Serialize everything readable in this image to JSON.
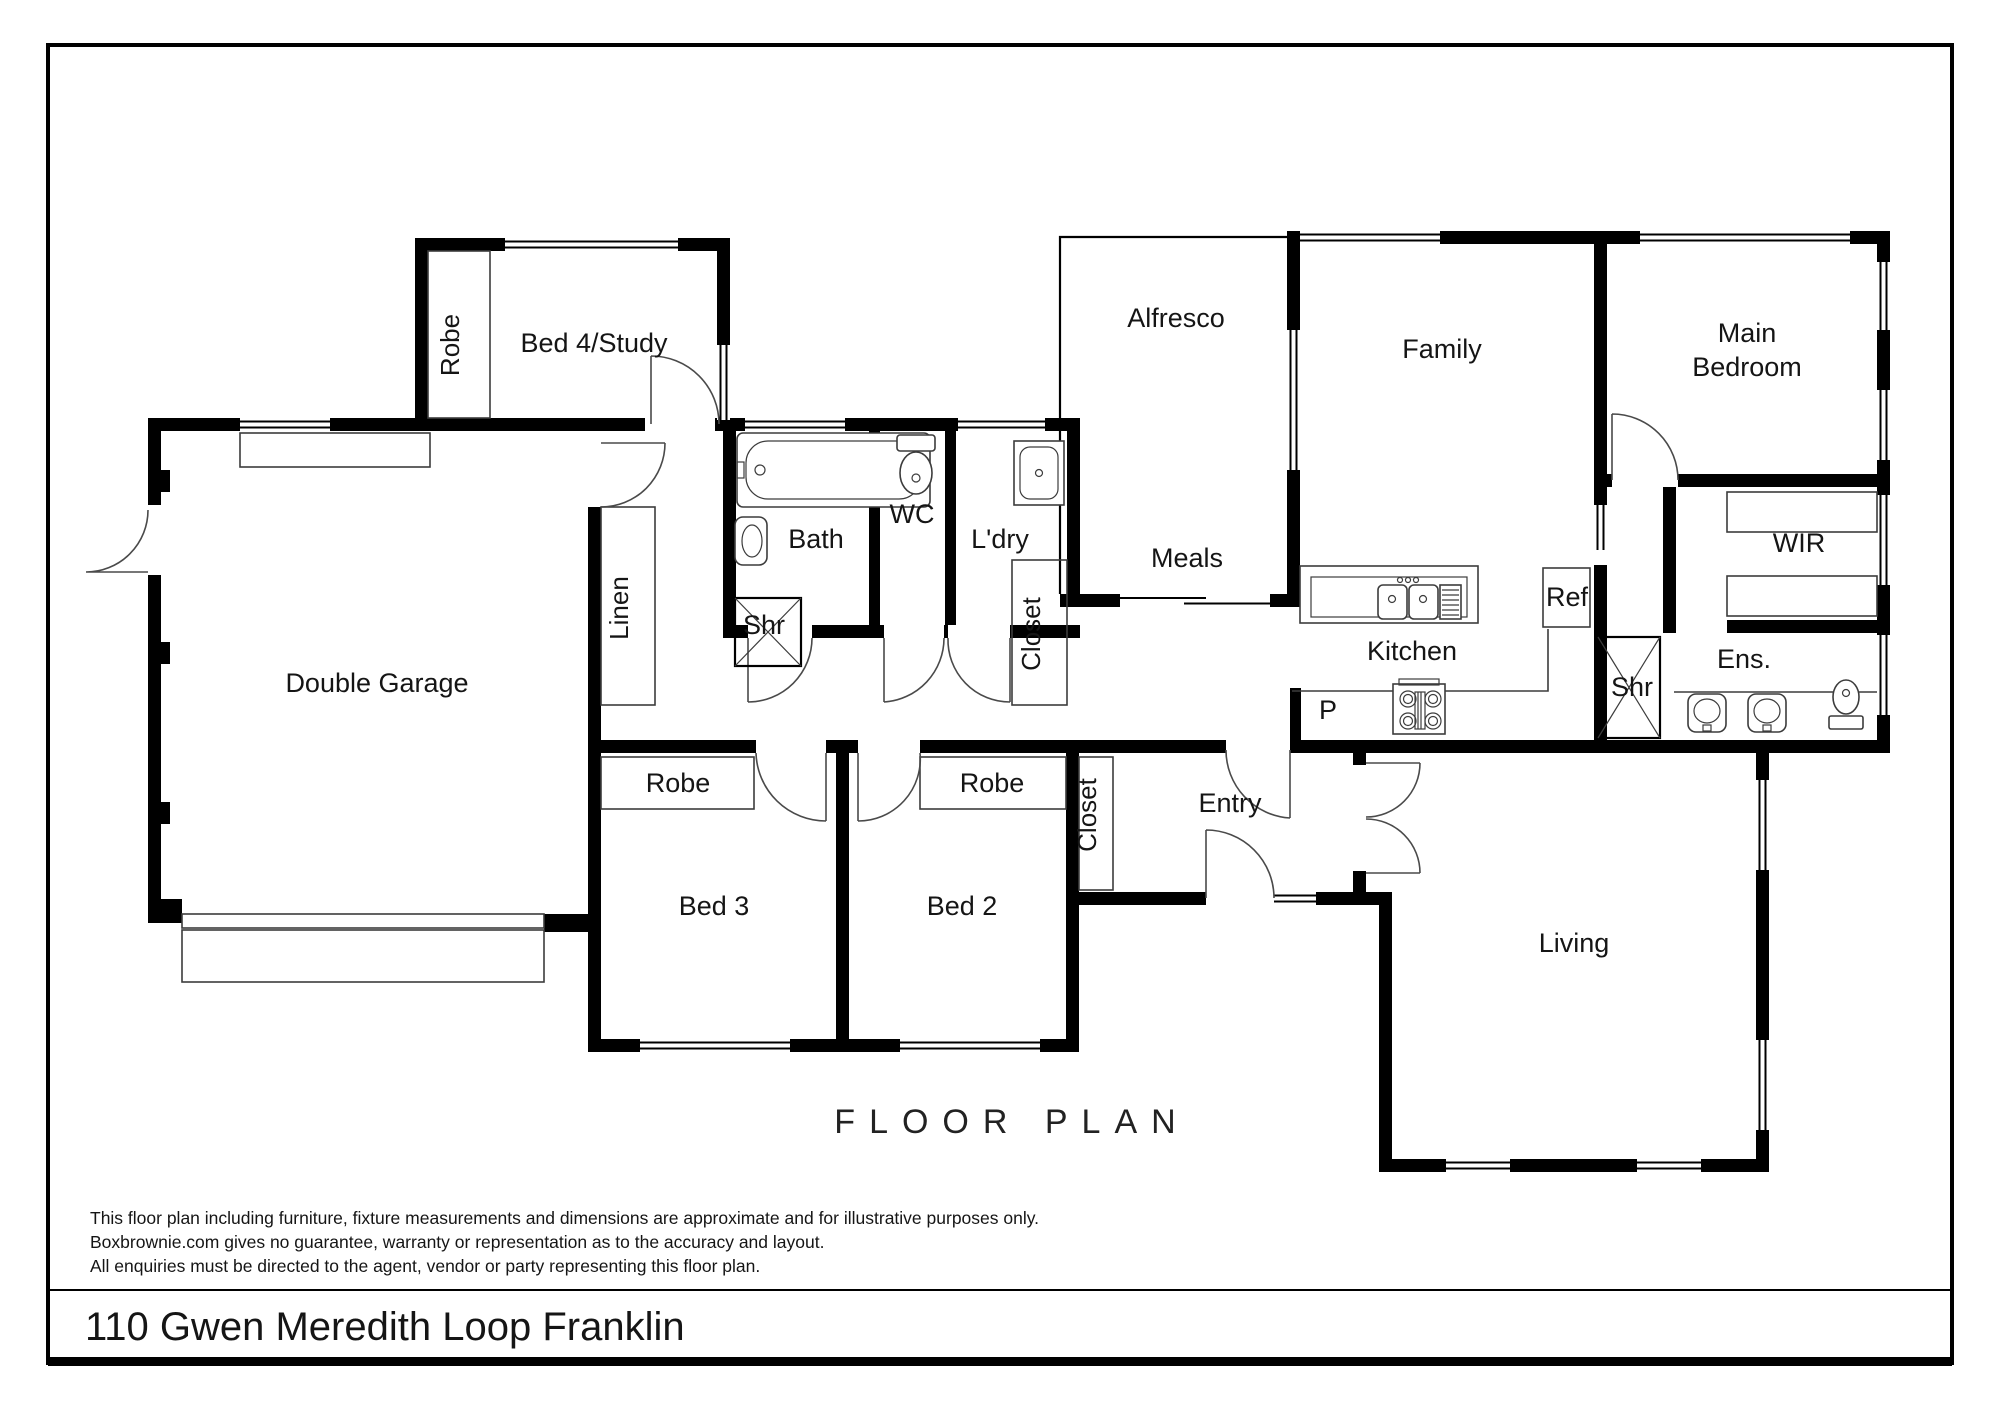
{
  "page": {
    "title": "FLOOR PLAN",
    "address": "110 Gwen Meredith Loop Franklin",
    "disclaimer": [
      "This floor plan including furniture, fixture measurements and dimensions are approximate and for illustrative purposes only.",
      "Boxbrownie.com gives no guarantee, warranty or representation as to the accuracy and layout.",
      "All enquiries must be directed to the agent, vendor or party representing this floor plan."
    ]
  },
  "rooms": {
    "bed4_study": "Bed 4/Study",
    "robe_bed4": "Robe",
    "alfresco": "Alfresco",
    "family": "Family",
    "main_bedroom": {
      "line1": "Main",
      "line2": "Bedroom"
    },
    "double_garage": "Double Garage",
    "linen": "Linen",
    "bath": "Bath",
    "shr_bath": "Shr",
    "wc": "WC",
    "laundry": "L'dry",
    "closet_laundry": "Closet",
    "meals": "Meals",
    "kitchen": "Kitchen",
    "fridge": "Ref",
    "pantry": "P",
    "shr_ens": "Shr",
    "ensuite": "Ens.",
    "wir": "WIR",
    "robe_bed3": "Robe",
    "robe_bed2": "Robe",
    "bed3": "Bed 3",
    "bed2": "Bed 2",
    "closet_entry": "Closet",
    "entry": "Entry",
    "living": "Living"
  },
  "colors": {
    "wall": "#000000",
    "background": "#ffffff",
    "line": "#3c3c3c"
  }
}
